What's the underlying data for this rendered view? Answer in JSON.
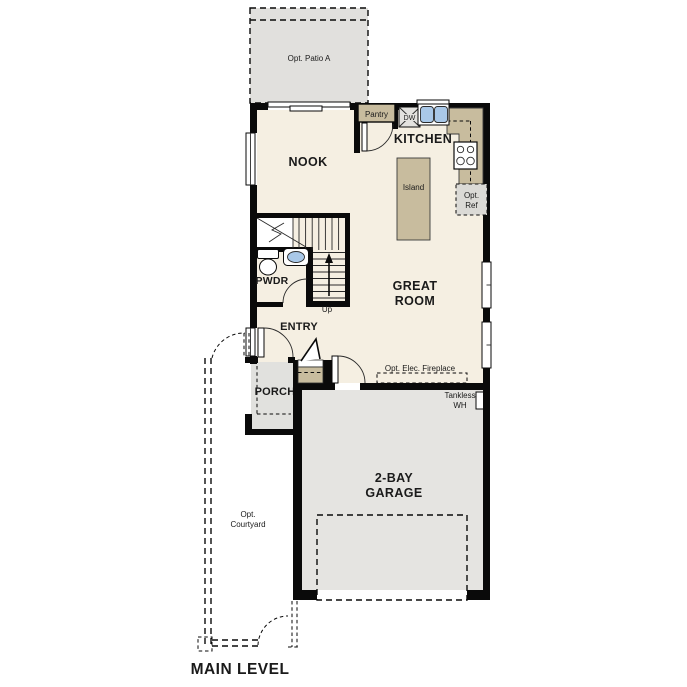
{
  "plan_title": "MAIN LEVEL",
  "colors": {
    "floor_cream": "#f5efe2",
    "cabinetry_tan": "#c8bc9e",
    "concrete_gray": "#e3e2df",
    "appliance_gray": "#dbdad6",
    "fixture_blue": "#a9c8e8",
    "wall_black": "#0a0a0a",
    "text": "#1a1a1a"
  },
  "rooms": {
    "nook": "NOOK",
    "kitchen": "KITCHEN",
    "great_room_line1": "GREAT",
    "great_room_line2": "ROOM",
    "pwdr": "PWDR",
    "entry": "ENTRY",
    "porch": "PORCH",
    "garage_line1": "2-BAY",
    "garage_line2": "GARAGE"
  },
  "labels": {
    "opt_patio": "Opt. Patio A",
    "pantry": "Pantry",
    "dishwasher": "DW",
    "island": "Island",
    "opt_ref_line1": "Opt.",
    "opt_ref_line2": "Ref",
    "stairs_up": "Up",
    "fireplace": "Opt. Elec. Fireplace",
    "tankless_line1": "Tankless",
    "tankless_line2": "WH",
    "courtyard_line1": "Opt.",
    "courtyard_line2": "Courtyard"
  }
}
